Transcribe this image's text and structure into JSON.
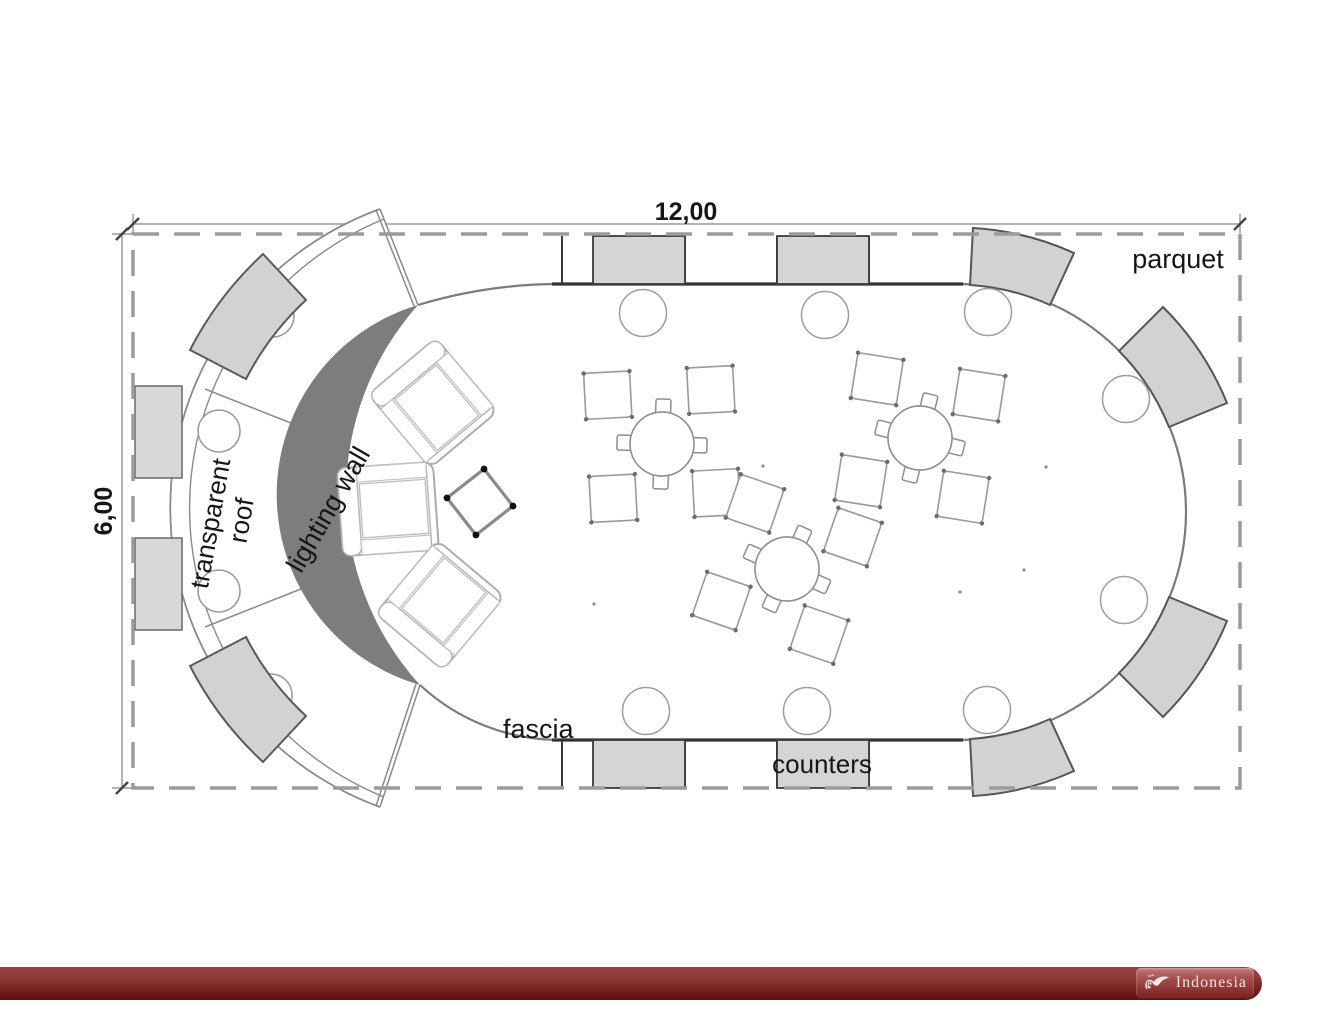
{
  "dimensions": {
    "width": "12,00",
    "height": "6,00"
  },
  "annotations": {
    "parquet": "parquet",
    "transparent_roof_1": "transparent",
    "transparent_roof_2": "roof",
    "lighting_wall": "lighting wall",
    "fascia": "fascia",
    "counters": "counters"
  },
  "footer": {
    "brand": "Indonesia"
  },
  "colors": {
    "accent_red": "#7a1e1e",
    "panel_gray": "#d5d5d5",
    "lighting_wall_gray": "#7d7d7d",
    "line_gray": "#8a8a8a",
    "dash_border_gray": "#9b9b9b"
  }
}
